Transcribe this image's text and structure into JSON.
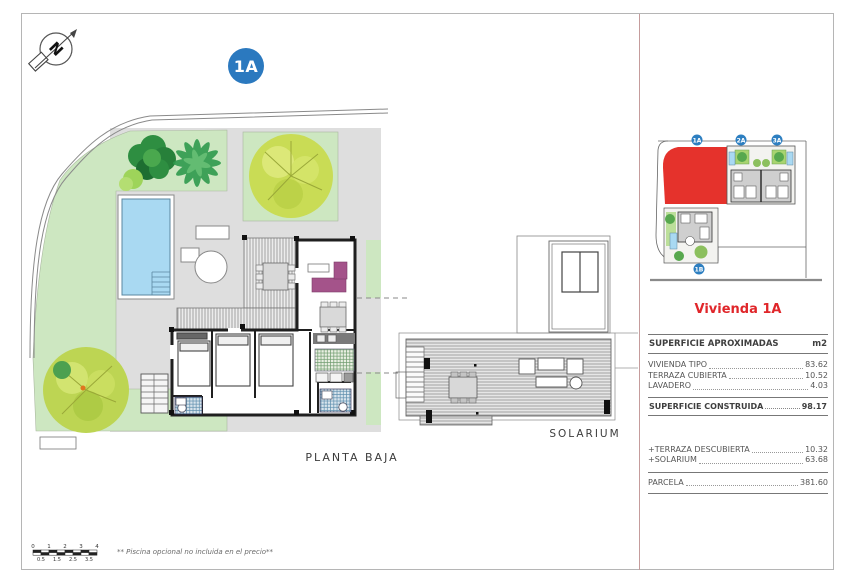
{
  "page": {
    "main_badge": "1A",
    "planta_label": "PLANTA BAJA",
    "solarium_label": "SOLARIUM",
    "footnote": "** Piscina opcional no incluida en el precio**"
  },
  "inset": {
    "badges": [
      {
        "label": "1A"
      },
      {
        "label": "2A"
      },
      {
        "label": "3A"
      },
      {
        "label": "1B"
      }
    ],
    "highlight_plot": "1A",
    "highlight_color": "#e5322c",
    "badge_color": "#2d7fc1"
  },
  "info_panel": {
    "title": "Vivienda 1A",
    "header": {
      "label": "SUPERFICIE APROXIMADAS",
      "unit": "m2"
    },
    "rows": [
      {
        "label": "VIVIENDA TIPO",
        "value": "83.62"
      },
      {
        "label": "TERRAZA CUBIERTA",
        "value": "10.52"
      },
      {
        "label": "LAVADERO",
        "value": "4.03"
      }
    ],
    "total": {
      "label": "SUPERFICIE CONSTRUIDA",
      "value": "98.17"
    },
    "extras": [
      {
        "label": "+TERRAZA DESCUBIERTA",
        "value": "10.32"
      },
      {
        "label": "+SOLARIUM",
        "value": "63.68"
      }
    ],
    "parcel": {
      "label": "PARCELA",
      "value": "381.60"
    }
  },
  "scalebar": {
    "top": [
      "0",
      "1",
      "2",
      "3",
      "4"
    ],
    "bottom": [
      "0.5",
      "1.5",
      "2.5",
      "3.5"
    ]
  },
  "colors": {
    "garden_green": "#cde7c1",
    "terrace_gray": "#dedede",
    "pool_blue": "#a9d9f2",
    "accent_red": "#e5322c",
    "badge_blue": "#2b79bf",
    "divider_rose": "#c59c9c",
    "sofa_magenta": "#a4538a"
  }
}
